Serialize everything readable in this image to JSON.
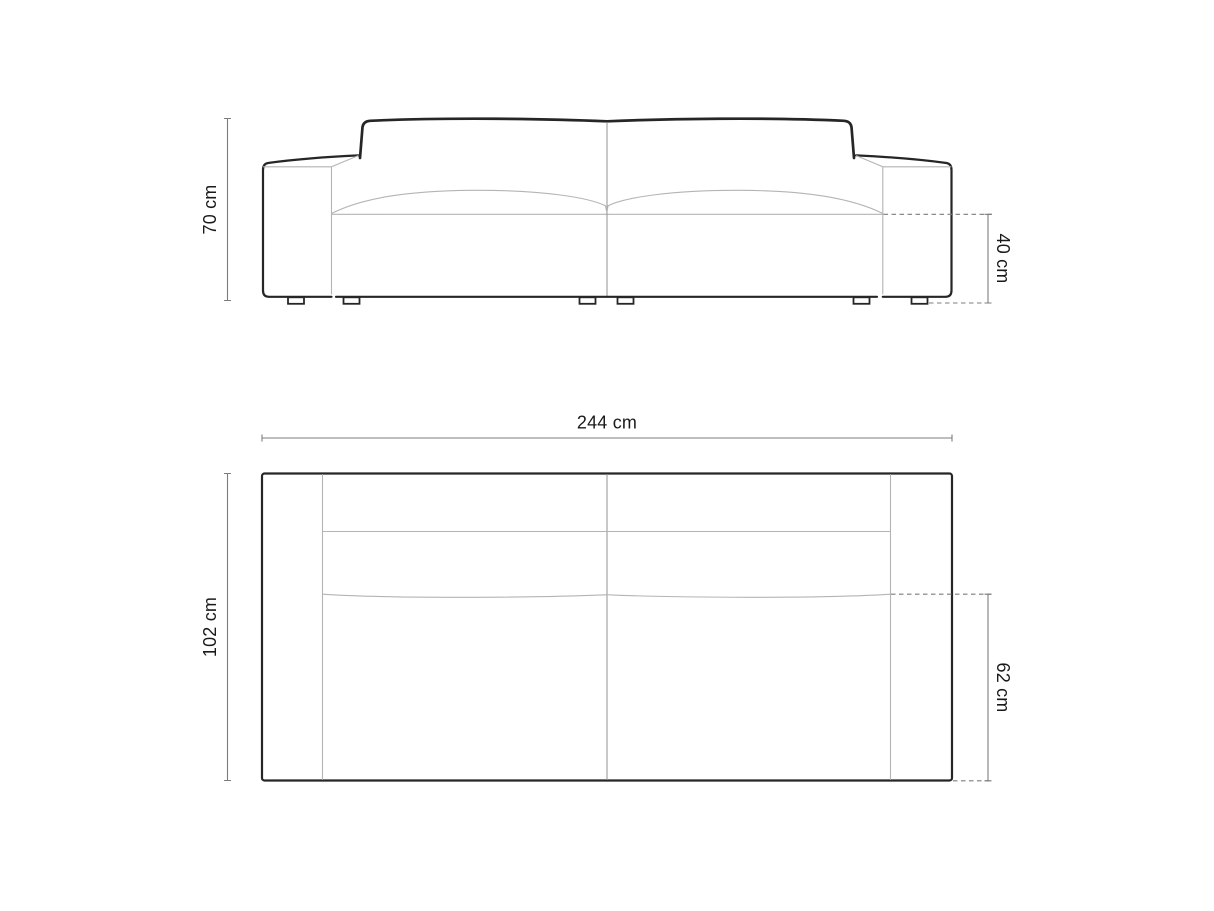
{
  "diagram": {
    "type": "furniture-dimension-drawing",
    "subject": "three-seat sofa technical drawing, front elevation and plan view",
    "unit": "cm",
    "views": {
      "front": {
        "name": "front-elevation",
        "dimensions": {
          "overall_height": {
            "label": "70 cm",
            "value_cm": 70,
            "orientation": "vertical-left"
          },
          "seat_height": {
            "label": "40 cm",
            "value_cm": 40,
            "orientation": "vertical-right"
          }
        }
      },
      "top": {
        "name": "plan-view",
        "dimensions": {
          "overall_width": {
            "label": "244 cm",
            "value_cm": 244,
            "orientation": "horizontal-top"
          },
          "overall_depth": {
            "label": "102 cm",
            "value_cm": 102,
            "orientation": "vertical-left"
          },
          "seat_depth": {
            "label": "62 cm",
            "value_cm": 62,
            "orientation": "vertical-right"
          }
        }
      }
    },
    "colors": {
      "background": "#ffffff",
      "outline": "#262626",
      "seam": "#b4b4b4",
      "seam_dark": "#9a9a9a",
      "dimension_line": "#7d7d7d",
      "text": "#1a1a1a"
    }
  }
}
